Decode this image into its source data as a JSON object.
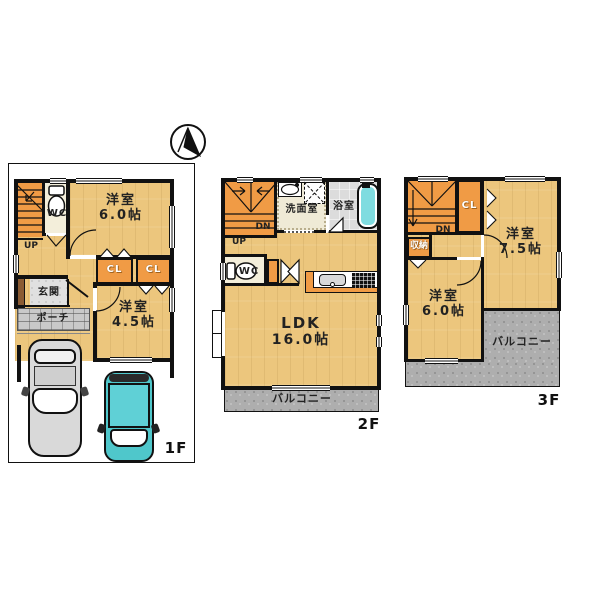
{
  "plan_type": "japanese-house-floor-plan",
  "colors": {
    "wall": "#111111",
    "wood_floor": "#ECC67D",
    "accent_orange": "#F09B45",
    "balcony_gray": "#AEAEAE",
    "bathtub_cyan": "#7FDCE0",
    "entry_tile": "#E0E0E0",
    "porch_tile": "#C9C9C9",
    "car_gray": "#D9D9D9",
    "car_teal": "#4FC7CB",
    "entry_wall_brown": "#8A5B33"
  },
  "floor1": {
    "tag": "1F",
    "bedroom6": {
      "name": "洋室",
      "size": "6.0帖"
    },
    "bedroom45": {
      "name": "洋室",
      "size": "4.5帖"
    },
    "wc": "WC",
    "up": "UP",
    "cl1": "CL",
    "cl2": "CL",
    "genkan": "玄関",
    "porch": "ポーチ"
  },
  "floor2": {
    "tag": "2F",
    "ldk": {
      "name": "LDK",
      "size": "16.0帖"
    },
    "senmen": "洗面室",
    "bath": "浴室",
    "wc": "WC",
    "up": "UP",
    "dn": "DN",
    "balcony": "バルコニー"
  },
  "floor3": {
    "tag": "3F",
    "bedroom75": {
      "name": "洋室",
      "size": "7.5帖"
    },
    "bedroom6": {
      "name": "洋室",
      "size": "6.0帖"
    },
    "cl": "CL",
    "dn": "DN",
    "storage": "収納",
    "balcony": "バルコニー"
  }
}
